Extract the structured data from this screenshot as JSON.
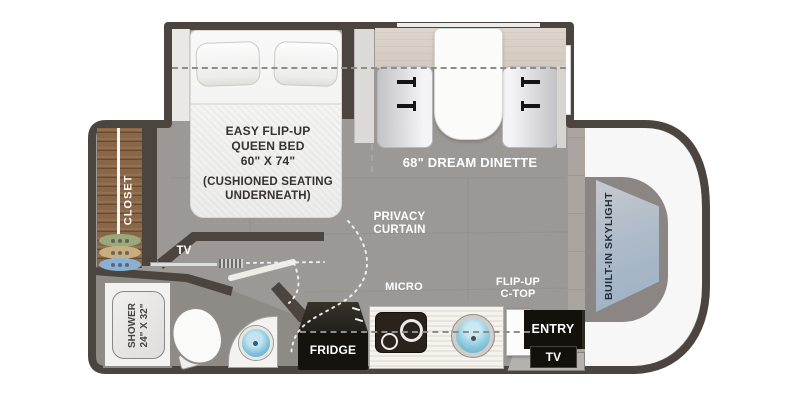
{
  "plan": {
    "bedroom": {
      "bed_title": [
        "EASY FLIP-UP",
        "QUEEN BED",
        "60\" X 74\""
      ],
      "bed_note": [
        "(CUSHIONED SEATING",
        "UNDERNEATH)"
      ],
      "tv_label": "TV",
      "closet_label": "CLOSET"
    },
    "dinette": {
      "label": "68\" DREAM DINETTE"
    },
    "privacy_curtain": {
      "line1": "PRIVACY",
      "line2": "CURTAIN"
    },
    "bathroom": {
      "shower_line1": "SHOWER",
      "shower_line2": "24\" X 32\""
    },
    "kitchen": {
      "micro_label": "MICRO",
      "fridge_label": "FRIDGE",
      "flipup_line1": "FLIP-UP",
      "flipup_line2": "C-TOP"
    },
    "entry": {
      "entry_label": "ENTRY",
      "tv_label": "TV"
    },
    "cab": {
      "skylight_label": "BUILT-IN SKYLIGHT"
    },
    "colors": {
      "wall": "#4c443f",
      "floor": "#9c9895",
      "bath_floor": "#8e8a86",
      "closet_wood": "#8a6646",
      "overhead_beige": "#d7cdc4",
      "sink_blue": "#7fc4dd",
      "skylight_blue": "#a9b6c2",
      "cab_white": "#f7f7f7"
    }
  }
}
